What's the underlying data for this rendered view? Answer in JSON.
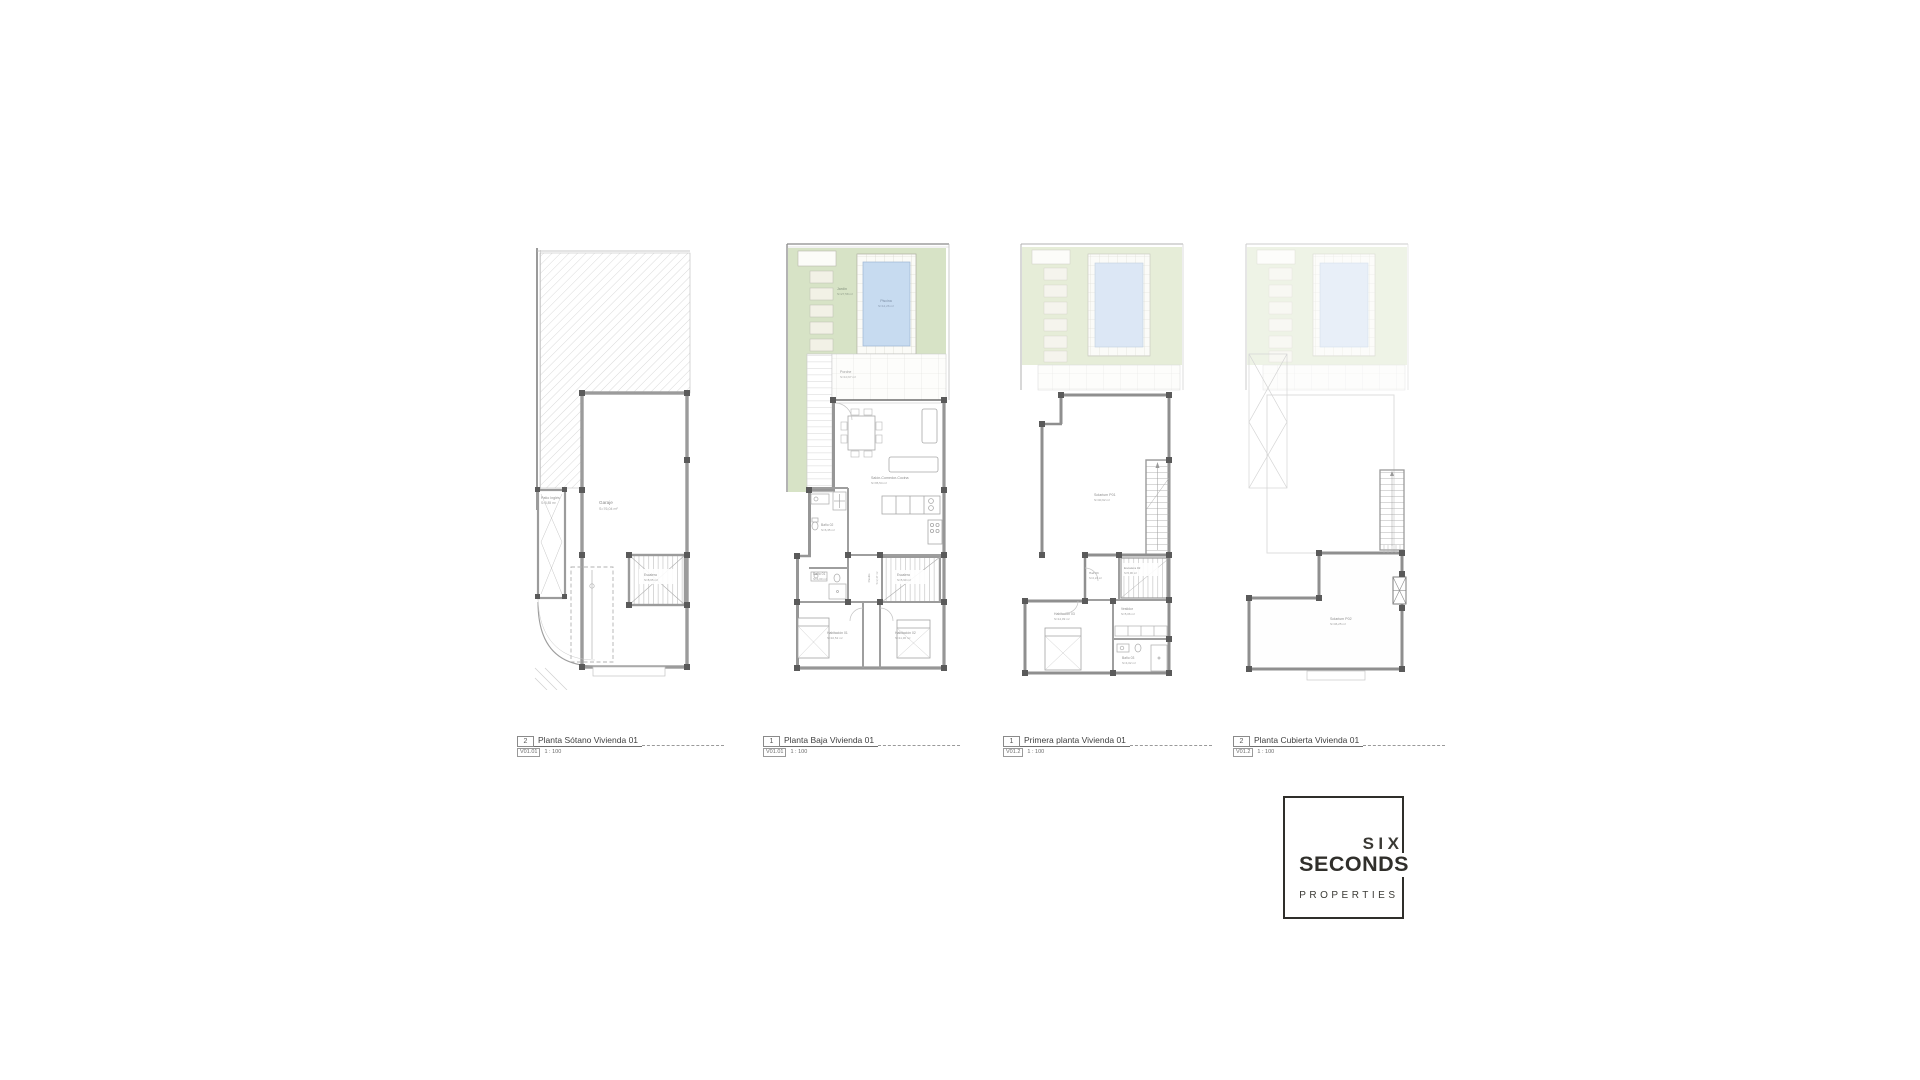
{
  "colors": {
    "wall": "#8f8f8f",
    "pillar": "#5a5a5a",
    "garden_green": "#d7e3c6",
    "garden_green_faded": "#dfe8ce",
    "pool_blue": "#c7dbf0",
    "pool_blue_faded": "#d3e1f3",
    "label_gray": "#8d8d8d",
    "logo_ink": "#302f2b"
  },
  "plans": [
    {
      "caption": {
        "number": "2",
        "title": "Planta Sótano Vivienda 01",
        "sheet": "V01.01",
        "scale": "1 : 100"
      },
      "rooms": {
        "patio": {
          "name": "Patio Inglés",
          "area": "S=5,85 m²"
        },
        "garaje": {
          "name": "Garaje",
          "area": "S=76,04 m²"
        },
        "escalera": {
          "name": "Escalera",
          "area": "S=8,65 m²"
        }
      }
    },
    {
      "caption": {
        "number": "1",
        "title": "Planta Baja Vivienda 01",
        "sheet": "V01.01",
        "scale": "1 : 100"
      },
      "rooms": {
        "jardin": {
          "name": "Jardín",
          "area": "S=27,58 m²"
        },
        "piscina": {
          "name": "Piscina",
          "area": "S=12,26 m²"
        },
        "porche": {
          "name": "Porche",
          "area": "S=10,67 m²"
        },
        "salon": {
          "name": "Salón-Comedor-Cocina",
          "area": "S=35,54 m²"
        },
        "bano02": {
          "name": "Baño 02",
          "area": "S=6,35 m²"
        },
        "bano01": {
          "name": "Baño 01",
          "area": "S=4,00 m²"
        },
        "pasillo": {
          "name": "Pasillo",
          "area": "S=2,47 m²"
        },
        "escalera": {
          "name": "Escalera",
          "area": "S=5,90 m²"
        },
        "hab01": {
          "name": "Habitación 01",
          "area": "S=10,52 m²"
        },
        "hab02": {
          "name": "Habitación 02",
          "area": "S=11,36 m²"
        }
      }
    },
    {
      "caption": {
        "number": "1",
        "title": "Primera planta Vivienda 01",
        "sheet": "V01.2",
        "scale": "1 : 100"
      },
      "rooms": {
        "solarium": {
          "name": "Solarium P01",
          "area": "S=40,92 m²"
        },
        "hall": {
          "name": "Hall 03",
          "area": "S=2,24 m²"
        },
        "escalera02": {
          "name": "Escalera 02",
          "area": "S=5,96 m²"
        },
        "hab03": {
          "name": "Habitación 03",
          "area": "S=14,09 m²"
        },
        "vestidor": {
          "name": "Vestidor",
          "area": "S=5,06 m²"
        },
        "bano03": {
          "name": "Baño 03",
          "area": "S=4,02 m²"
        }
      }
    },
    {
      "caption": {
        "number": "2",
        "title": "Planta Cubierta Vivienda 01",
        "sheet": "V01.2",
        "scale": "1 : 100"
      },
      "rooms": {
        "solarium": {
          "name": "Solarium P02",
          "area": "S=46,25 m²"
        }
      }
    }
  ],
  "logo": {
    "line1": "SIX",
    "line2": "SECONDS",
    "line3": "PROPERTIES"
  }
}
